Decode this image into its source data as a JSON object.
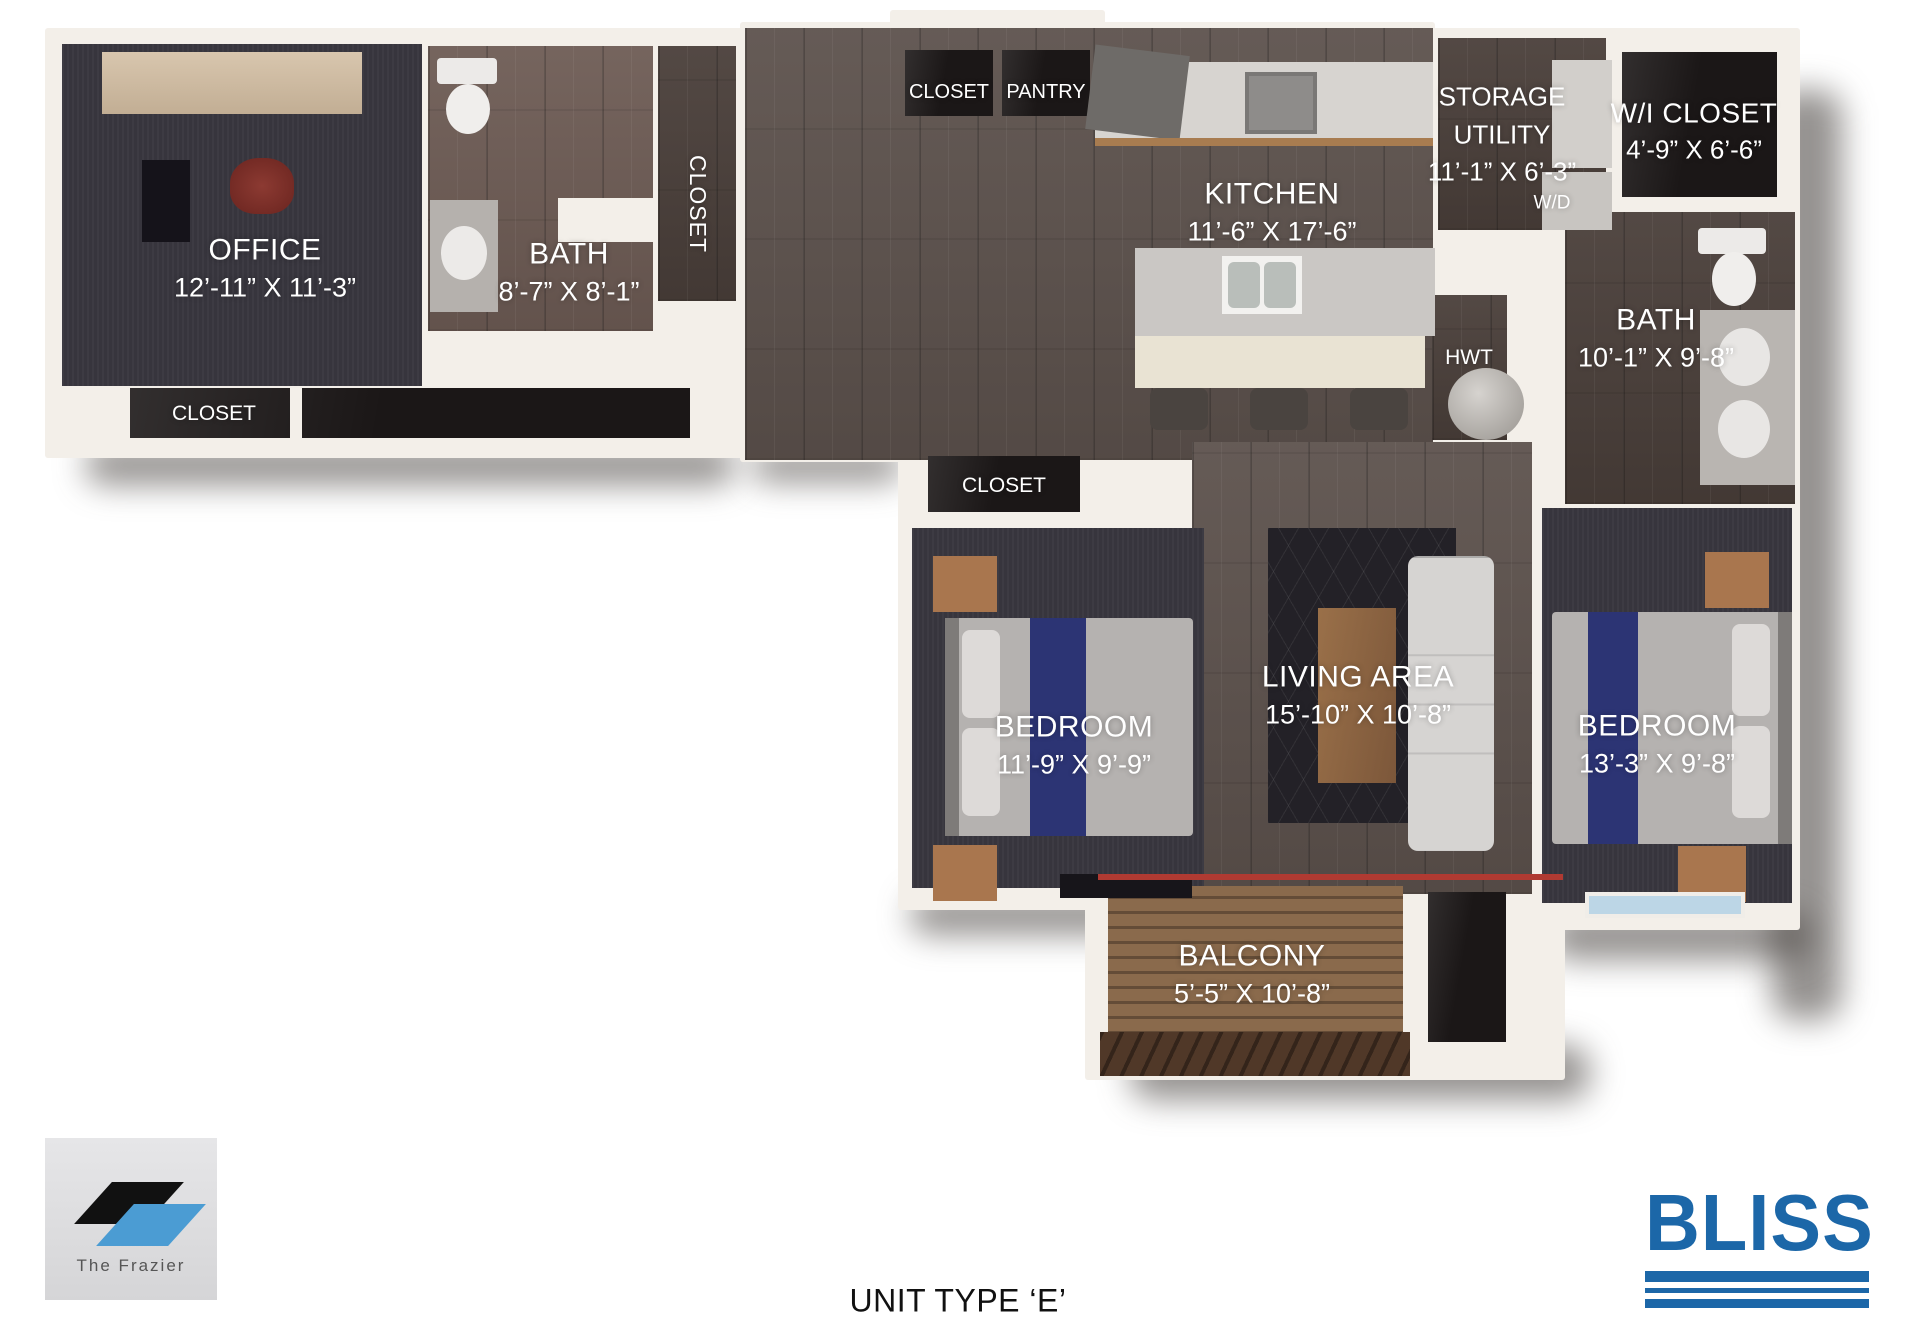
{
  "rooms": {
    "office": {
      "name": "OFFICE",
      "dims": "12’-11” X 11’-3”"
    },
    "office_closet": {
      "name": "CLOSET"
    },
    "bath1": {
      "name": "BATH",
      "dims": "8’-7” X 8’-1”"
    },
    "hall_closet": {
      "name": "CLOSET"
    },
    "entry_closet": {
      "name": "CLOSET"
    },
    "pantry": {
      "name": "PANTRY"
    },
    "kitchen": {
      "name": "KITCHEN",
      "dims": "11’-6” X 17’-6”"
    },
    "storage_utility": {
      "name_line1": "STORAGE",
      "name_line2": "UTILITY",
      "dims": "11’-1” X 6’-3”",
      "appliance": "W/D"
    },
    "wi_closet": {
      "name": "W/I CLOSET",
      "dims": "4’-9” X 6’-6”"
    },
    "bath2": {
      "name": "BATH",
      "dims": "10’-1” X 9’-8”"
    },
    "hwt": {
      "name": "HWT"
    },
    "bedroom_closet": {
      "name": "CLOSET"
    },
    "bedroom1": {
      "name": "BEDROOM",
      "dims": "11’-9” X 9’-9”"
    },
    "living": {
      "name": "LIVING AREA",
      "dims": "15’-10” X 10’-8”"
    },
    "bedroom2": {
      "name": "BEDROOM",
      "dims": "13’-3” X 9’-8”"
    },
    "balcony": {
      "name": "BALCONY",
      "dims": "5’-5” X 10’-8”"
    }
  },
  "footer": {
    "unit_type": "UNIT TYPE ‘E’"
  },
  "logos": {
    "frazier": {
      "text": "The Frazier"
    },
    "bliss": {
      "text": "BLISS"
    }
  },
  "colors": {
    "bliss_blue": "#1c67a8",
    "frazier_blue": "#4b9cd3",
    "navy_bed_runner": "#2c3474",
    "threshold_red": "#b03a32"
  }
}
